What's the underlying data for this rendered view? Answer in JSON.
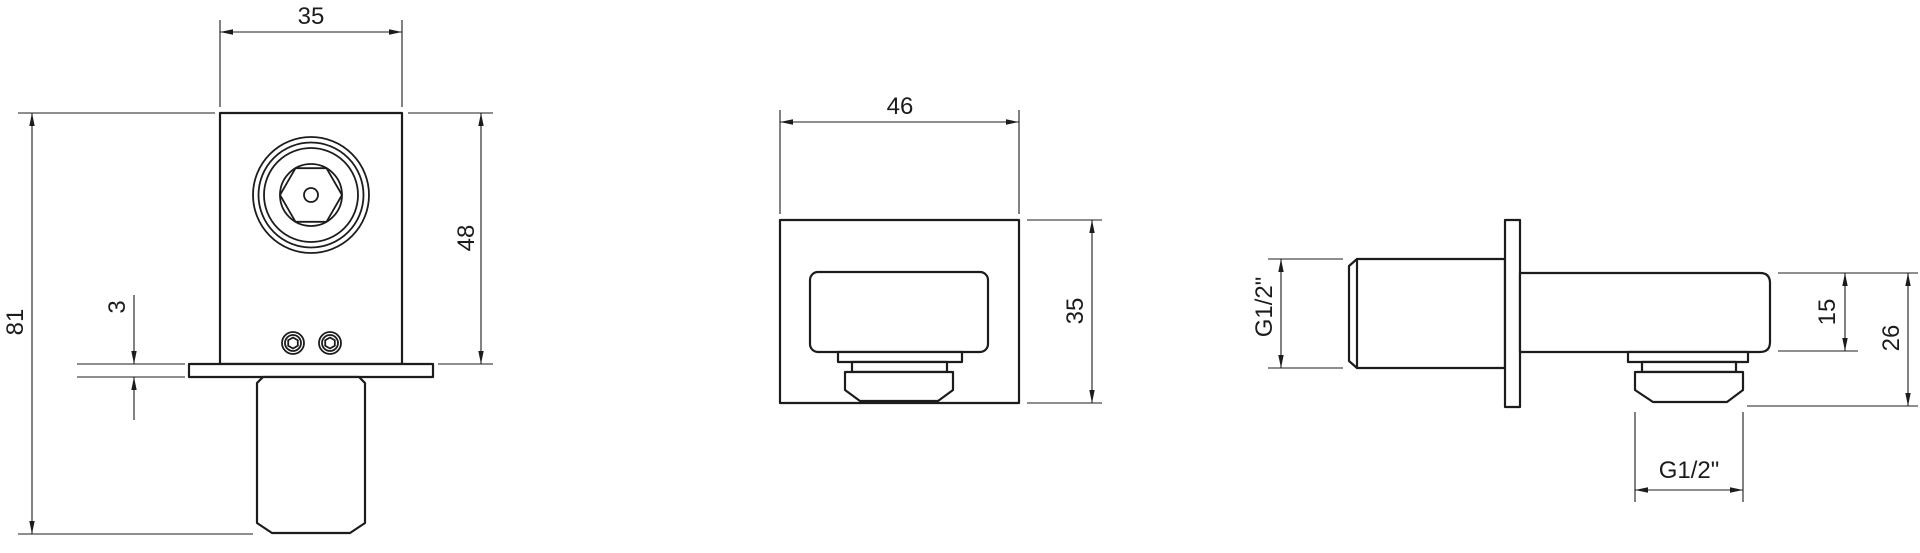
{
  "drawing": {
    "type": "technical-dimension-drawing",
    "subject": "square wall outlet elbow, three orthographic views",
    "colors": {
      "line": "#1c1c1c",
      "background": "#ffffff"
    },
    "labels": {
      "front_width": "35",
      "front_overall_height": "81",
      "front_body_height": "48",
      "front_plate_thickness": "3",
      "bottom_plate_width": "46",
      "bottom_plate_depth": "35",
      "side_inlet_thread": "G1/2\"",
      "side_body_depth": "15",
      "side_overall_depth": "26",
      "side_outlet_thread": "G1/2\""
    }
  }
}
